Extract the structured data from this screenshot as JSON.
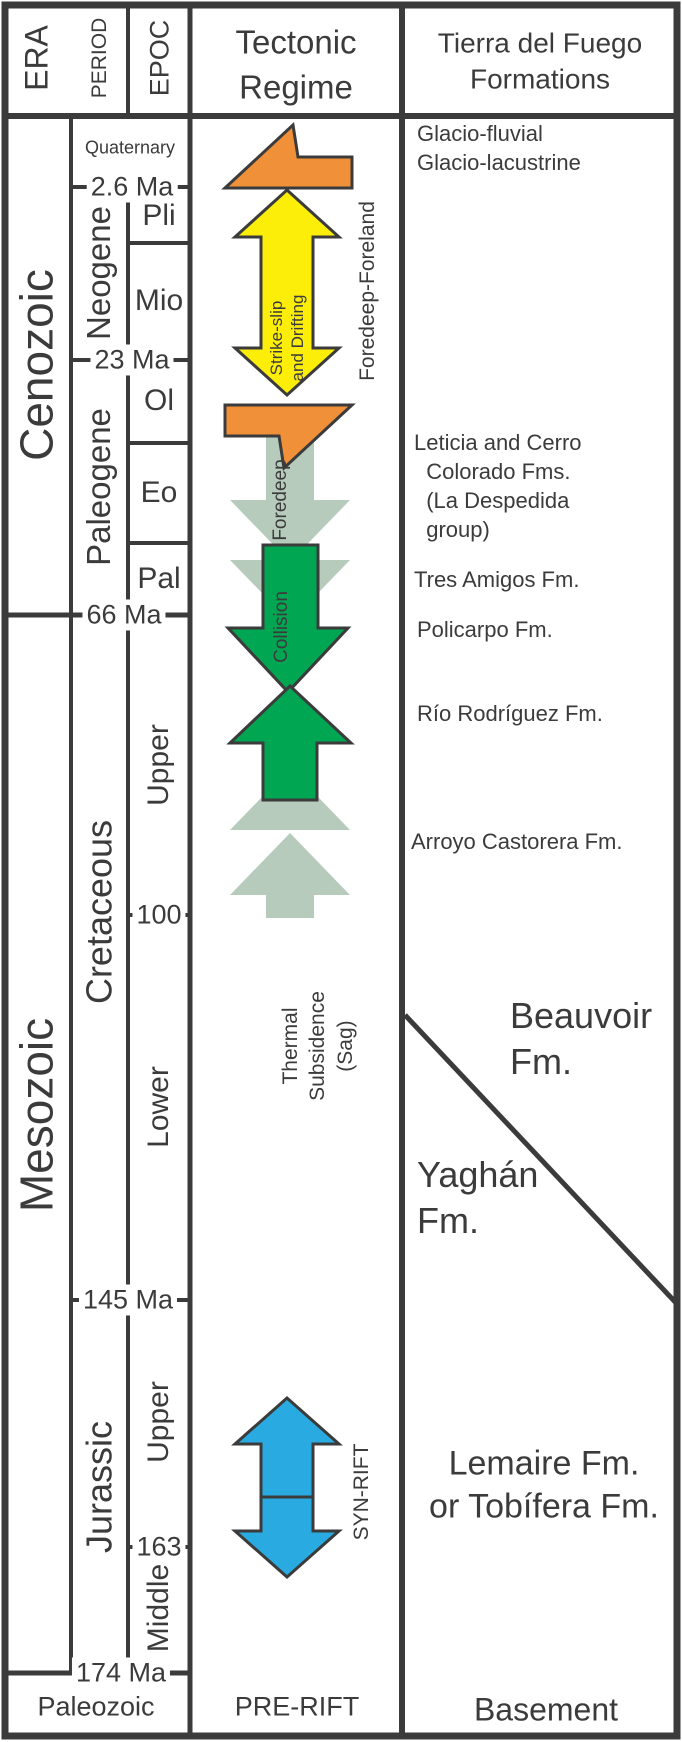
{
  "title": "Tierra del Fuego tectonostratigraphic chart",
  "colors": {
    "line": "#3b3b3c",
    "orange_arrow": "#f0913a",
    "yellow_arrow": "#fdee0a",
    "green_arrow": "#00a651",
    "sage_arrow": "#b7cbbd",
    "blue_arrow": "#29abe2",
    "background": "#ffffff"
  },
  "header": {
    "era": "ERA",
    "period": "PERIOD",
    "epoch": "EPOC",
    "tectonic_regime": "Tectonic Regime",
    "formations": "Tierra del Fuego Formations"
  },
  "eras": {
    "cenozoic": "Cenozoic",
    "mesozoic": "Mesozoic",
    "paleozoic": "Paleozoic"
  },
  "periods": {
    "quaternary": "Quaternary",
    "neogene": "Neogene",
    "paleogene": "Paleogene",
    "cretaceous": "Cretaceous",
    "jurassic": "Jurassic"
  },
  "epochs": {
    "pli": "Pli",
    "mio": "Mio",
    "ol": "Ol",
    "eo": "Eo",
    "pal": "Pal",
    "upper_cretaceous": "Upper",
    "lower_cretaceous": "Lower",
    "upper_jurassic": "Upper",
    "middle_jurassic": "Middle"
  },
  "age_ticks": {
    "quaternary_base": "2.6 Ma",
    "neogene_base": "23 Ma",
    "paleogene_base": "66 Ma",
    "upper_cretaceous_base": "100",
    "cretaceous_base": "145 Ma",
    "upper_jurassic_base": "163",
    "jurassic_base": "174 Ma"
  },
  "tectonic": {
    "strike_slip": "Strike-slip\nand Drifting",
    "foredeep_foreland": "Foredeep-Foreland",
    "foredeep": "Foredeep",
    "collision": "Collision",
    "thermal_subsidence": "Thermal\nSubsidence\n(Sag)",
    "syn_rift": "SYN-RIFT",
    "pre_rift": "PRE-RIFT"
  },
  "formations": {
    "glacio": "Glacio-fluvial\nGlacio-lacustrine",
    "leticia": "Leticia and Cerro\n  Colorado Fms.\n  (La Despedida\n  group)",
    "tres_amigos": "Tres Amigos Fm.",
    "policarpo": "Policarpo Fm.",
    "rio_rodriguez": "Río Rodríguez Fm.",
    "arroyo_castorera": "Arroyo Castorera Fm.",
    "beauvoir": "Beauvoir\nFm.",
    "yaghan": "Yaghán\nFm.",
    "lemaire": "Lemaire Fm.\nor Tobífera Fm.",
    "basement": "Basement"
  }
}
